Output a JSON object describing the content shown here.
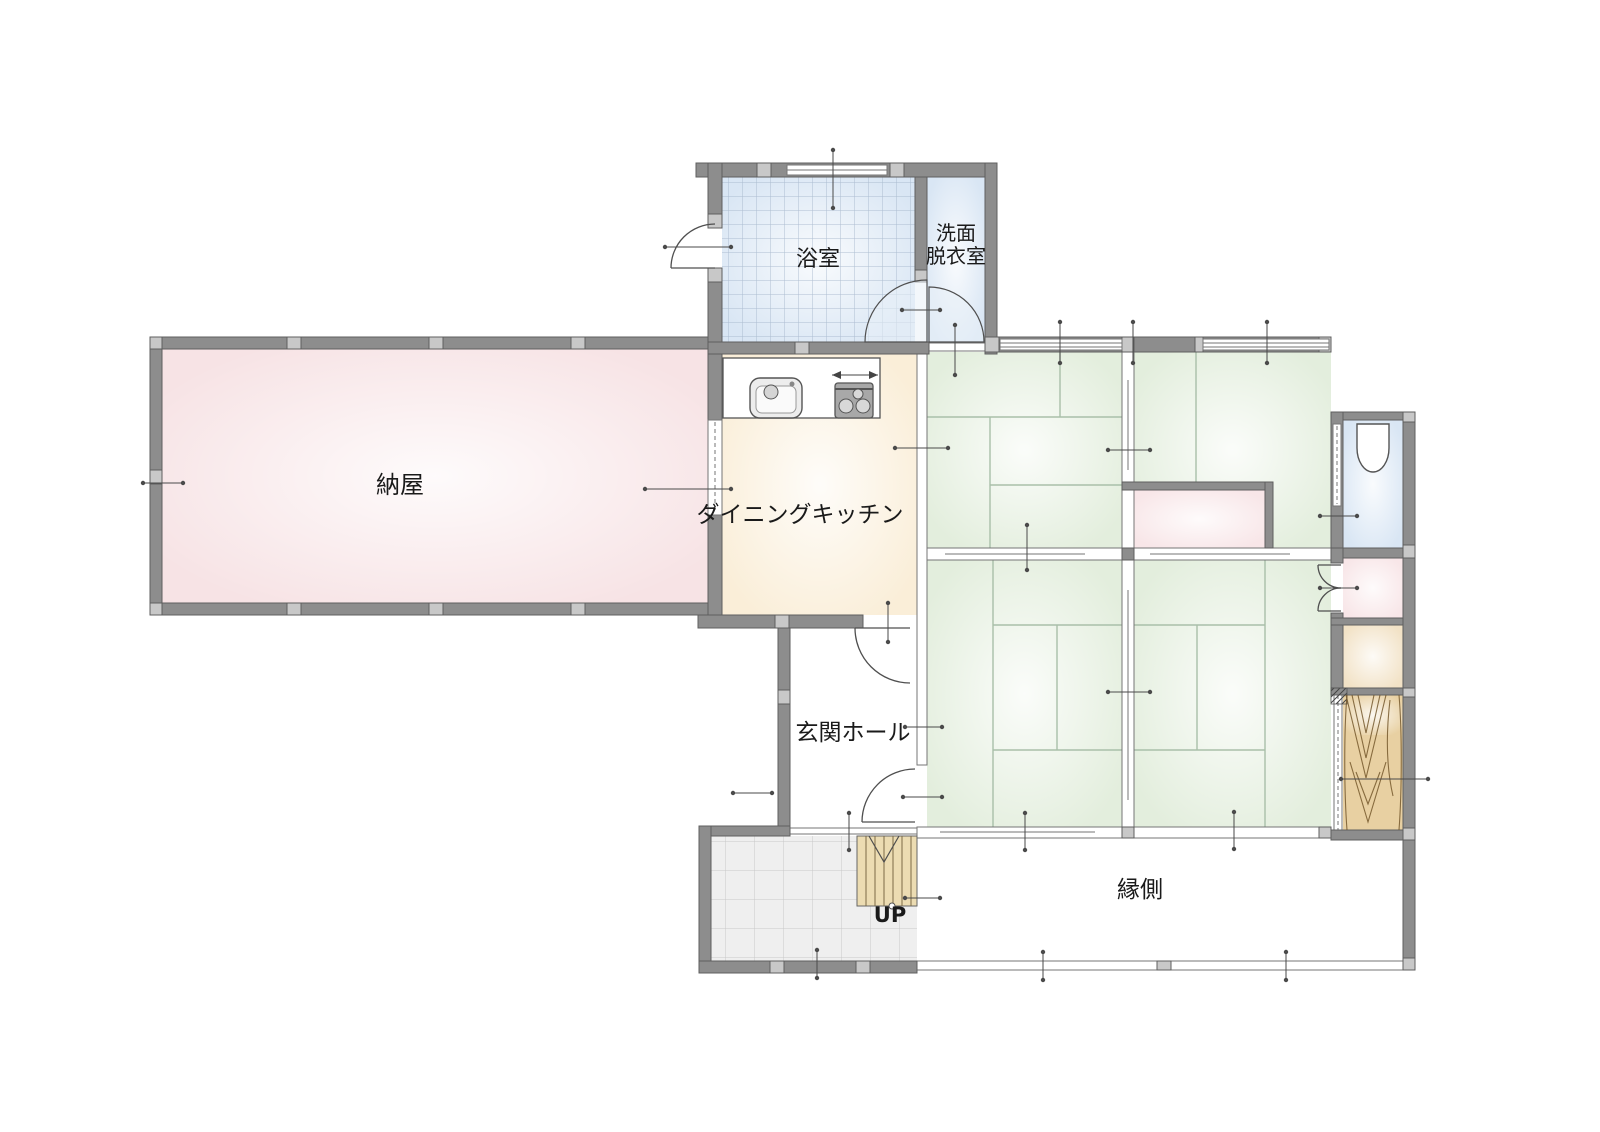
{
  "floor_plan": {
    "rooms": {
      "bathroom": {
        "label": "浴室"
      },
      "washroom_dressing": {
        "line1": "洗面",
        "line2": "脱衣室"
      },
      "barn": {
        "label": "納屋"
      },
      "dining_kitchen": {
        "label": "ダイニングキッチン"
      },
      "entrance_hall": {
        "label": "玄関ホール"
      },
      "veranda": {
        "label": "縁側"
      }
    },
    "stairs": {
      "label": "UP"
    },
    "icons": {
      "sink": "kitchen-sink-icon",
      "stove": "gas-stove-icon",
      "toilet": "toilet-icon",
      "stairs_up": "stairs-up-mark"
    },
    "colors": {
      "wall": "#8d8d8d",
      "wall_joint": "#c8c8c8",
      "barn": "#f7e3e5",
      "kitchen": "#faeed8",
      "tatami": "#e3eedd",
      "water_blue": "#d9e6f4",
      "closet_pink": "#f8e6e8",
      "storage_beige": "#f2e2c6",
      "wood": "#e8d0a2",
      "stairs_wood": "#ecdcb2",
      "genkan_tile": "#efefef",
      "mat_line": "#a9bfa9",
      "text": "#1a1a1a"
    }
  }
}
